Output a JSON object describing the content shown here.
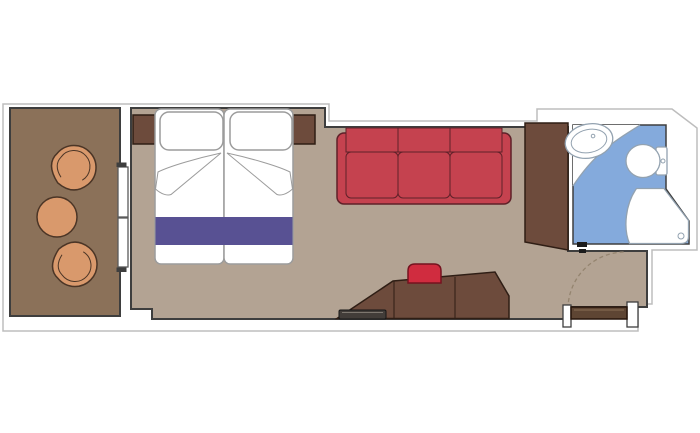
{
  "title": "Cruise cabin floor plan with balcony",
  "colors": {
    "white": "#ffffff",
    "wall": "#3e3e3e",
    "outline_gray": "#bdbdbd",
    "balcony_floor": "#8b7159",
    "cabin_floor": "#b3a393",
    "wood": "#6d4b3c",
    "wood_stroke": "#2f1e15",
    "bed_stroke": "#9c9c9c",
    "bed_runner": "#585193",
    "sofa": "#c5424f",
    "sofa_stroke": "#5f2129",
    "stool": "#d02c3f",
    "stool_stroke": "#75131f",
    "chair": "#d9996c",
    "chair_stroke": "#4b3526",
    "bath_floor": "#84aadc",
    "bath_fixture_stroke": "#93a2b0",
    "tv": "#423d39",
    "tv_stroke": "#161616",
    "door_leaf": "#5e4533",
    "door_leaf_stroke": "#27150b",
    "door_leaf_highlight": "#8a6f54",
    "swing_arc": "#94846f",
    "glass_stroke": "#5a5a5a",
    "hinge_mark": "#1c1c1c"
  },
  "floorplan": {
    "balcony": {
      "items": [
        "armchair-top",
        "round-table",
        "armchair-bottom"
      ],
      "access": "sliding-glass-door"
    },
    "bedroom": {
      "items": [
        "double-bed",
        "pillow-left",
        "pillow-right",
        "bed-runner",
        "nightstand-left",
        "nightstand-right",
        "sofa-3-seat",
        "desk-vanity",
        "tv",
        "stool",
        "wardrobe"
      ]
    },
    "bathroom": {
      "items": [
        "sink",
        "toilet",
        "shower"
      ]
    },
    "doors": [
      "balcony-sliding-door",
      "entrance-door",
      "bathroom-door"
    ]
  }
}
